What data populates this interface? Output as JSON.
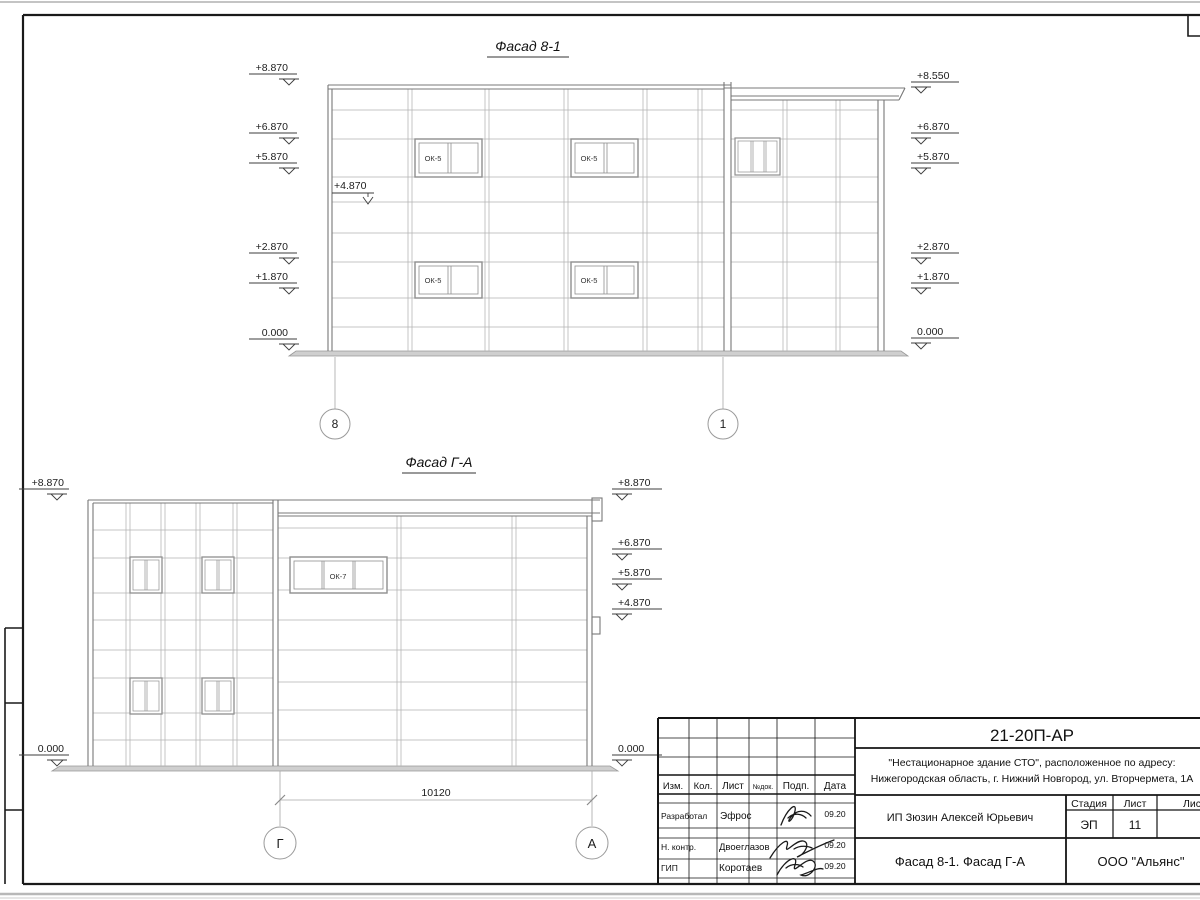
{
  "facade1": {
    "title": "Фасад 8-1",
    "marks_left": [
      "+8.870",
      "+6.870",
      "+5.870",
      "+2.870",
      "+1.870",
      "0.000"
    ],
    "mark_inner": "+4.870",
    "marks_right": [
      "+8.550",
      "+6.870",
      "+5.870",
      "+2.870",
      "+1.870",
      "0.000"
    ],
    "window_label": "ОК-5",
    "axis_left": "8",
    "axis_right": "1"
  },
  "facade2": {
    "title": "Фасад Г-А",
    "marks_left": [
      "+8.870",
      "0.000"
    ],
    "marks_right": [
      "+8.870",
      "+6.870",
      "+5.870",
      "+4.870",
      "0.000"
    ],
    "window_label": "ОК-7",
    "dimension": "10120",
    "axis_left": "Г",
    "axis_right": "А"
  },
  "titleblock": {
    "code": "21-20П-АР",
    "project_line1": "\"Нестационарное здание СТО\", расположенное по адресу:",
    "project_line2": "Нижегородская область, г. Нижний Новгород, ул. Вторчермета, 1А",
    "client": "ИП Зюзин Алексей Юрьевич",
    "sheet_name": "Фасад 8-1. Фасад Г-А",
    "company": "ООО \"Альянс\"",
    "stage_label": "Стадия",
    "sheet_label": "Лист",
    "sheets_label": "Листов",
    "stage_value": "ЭП",
    "sheet_value": "11",
    "columns": [
      "Изм.",
      "Кол.",
      "Лист",
      "№док.",
      "Подп.",
      "Дата"
    ],
    "rows": [
      {
        "role": "Разработал",
        "name": "Эфрос",
        "date": "09.20"
      },
      {
        "role": "Н. контр.",
        "name": "Двоеглазов",
        "date": "09.20"
      },
      {
        "role": "ГИП",
        "name": "Коротаев",
        "date": "09.20"
      }
    ]
  }
}
